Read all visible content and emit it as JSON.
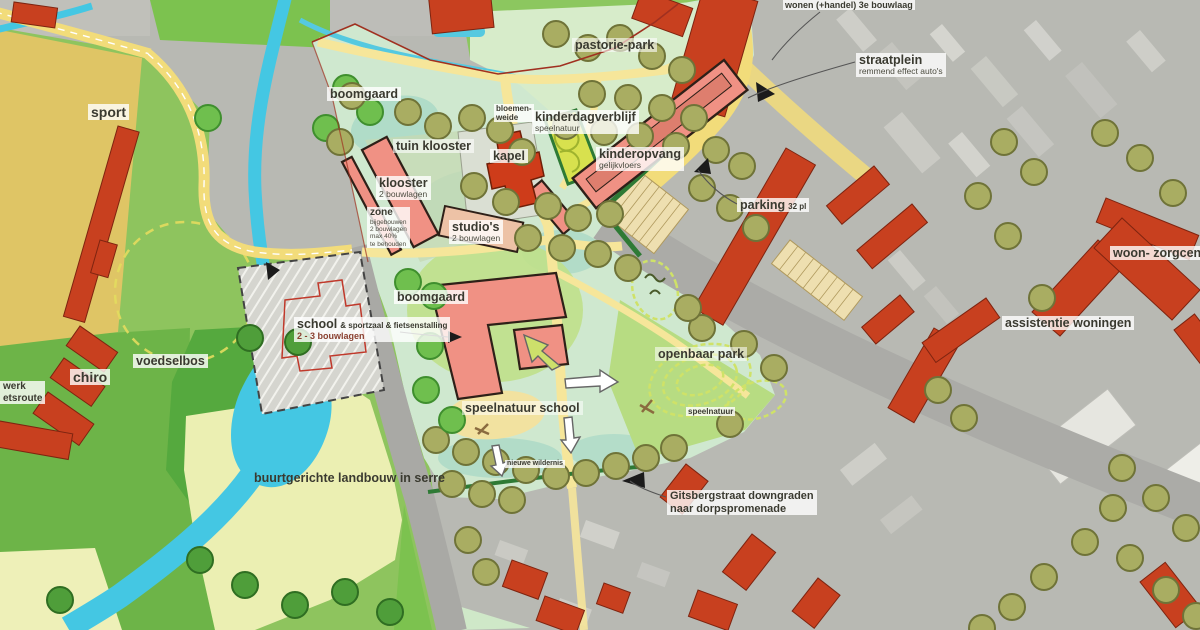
{
  "map": {
    "type": "masterplan-over-aerial-photo",
    "colors": {
      "existing_building": "#c8401f",
      "new_building": "#f09184",
      "water": "#44c7e3",
      "sport_field": "#dfc565",
      "meadow_green": "#8ec45e",
      "site_green": "#cfe8cf",
      "road_grey": "#a9a9a5",
      "path_yellow": "#f2dc7a",
      "aerial_grey": "#b8b9b3"
    }
  },
  "labels": {
    "sport": {
      "title": "sport"
    },
    "boomgaard_top": {
      "title": "boomgaard"
    },
    "tuin_klooster": {
      "title": "tuin klooster"
    },
    "klooster": {
      "title": "klooster",
      "sub": "2 bouwlagen"
    },
    "zone": {
      "title": "zone",
      "lines": [
        "bijgebouwen",
        "2 bouwlagen",
        "max 40%",
        "te behouden"
      ]
    },
    "kapel": {
      "title": "kapel"
    },
    "studios": {
      "title": "studio's",
      "sub": "2 bouwlagen"
    },
    "bloemenweide": {
      "line1": "bloemen-",
      "line2": "weide"
    },
    "kinderdagverblijf": {
      "title": "kinderdagverblijf",
      "sub": "speelnatuur"
    },
    "kinderopvang": {
      "title": "kinderopvang",
      "sub": "gelijkvloers"
    },
    "pastoriepark": {
      "title": "pastorie-park"
    },
    "wonen": {
      "title": "wonen (+handel) 3e bouwlaag"
    },
    "straatplein": {
      "title": "straatplein",
      "sub": "remmend effect auto's"
    },
    "parking": {
      "title": "parking",
      "sub": "32 pl"
    },
    "woonzorgcentrum": {
      "title": "woon- zorgcentrum"
    },
    "assistentiewoningen": {
      "title": "assistentie woningen"
    },
    "boomgaard_mid": {
      "title": "boomgaard"
    },
    "school": {
      "title": "school",
      "suffix": "& sportzaal & fietsenstalling",
      "sub": "2 - 3 bouwlagen"
    },
    "chiro": {
      "title": "chiro"
    },
    "voedselbos": {
      "title": "voedselbos"
    },
    "fietsroute": {
      "line1": "werk",
      "line2": "etsroute"
    },
    "landbouw": {
      "title": "buurtgerichte landbouw in serre"
    },
    "speelnatuur_school": {
      "title": "speelnatuur school"
    },
    "openbaar_park": {
      "title": "openbaar park"
    },
    "speelnatuur_klein": {
      "title": "speelnatuur"
    },
    "wildernis": {
      "title": "nieuwe wildernis"
    },
    "gitsbergstraat": {
      "line1": "Gitsbergstraat downgraden",
      "line2": "naar dorpspromenade"
    }
  }
}
